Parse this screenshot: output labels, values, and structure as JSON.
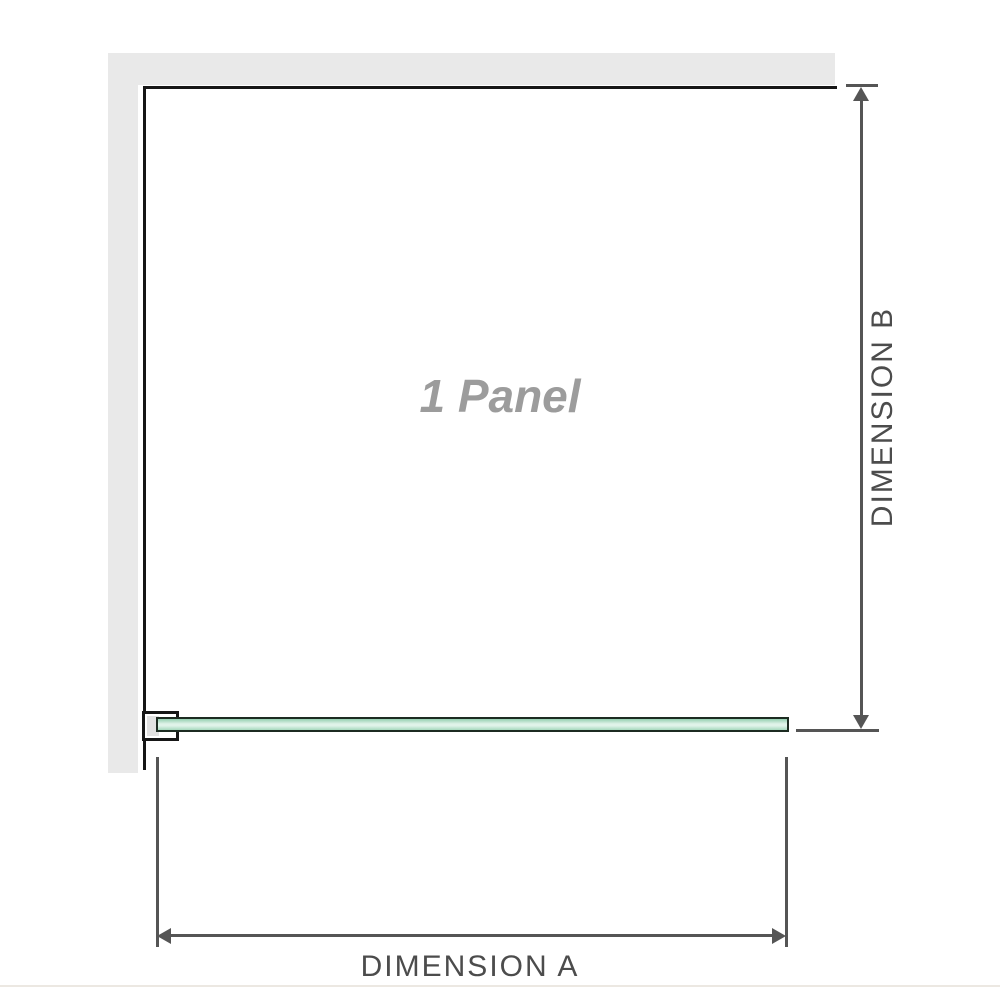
{
  "diagram": {
    "panel_label": "1 Panel",
    "dimension_a": {
      "label": "DIMENSION A"
    },
    "dimension_b": {
      "label": "DIMENSION B"
    }
  },
  "colors": {
    "wall_fill": "#e9e9e9",
    "wall_edge": "#161616",
    "bracket_fill": "#e1e1e1",
    "glass_edge": "#1c2b21",
    "glass_green": "#94cfb0",
    "glass_green2": "#a6d8bd",
    "glass_light": "#e0f3e9",
    "dim_line": "#555555",
    "dim_text": "#4c4c4c",
    "panel_text": "#9c9c9c",
    "footer_rule": "#ece8e2"
  }
}
